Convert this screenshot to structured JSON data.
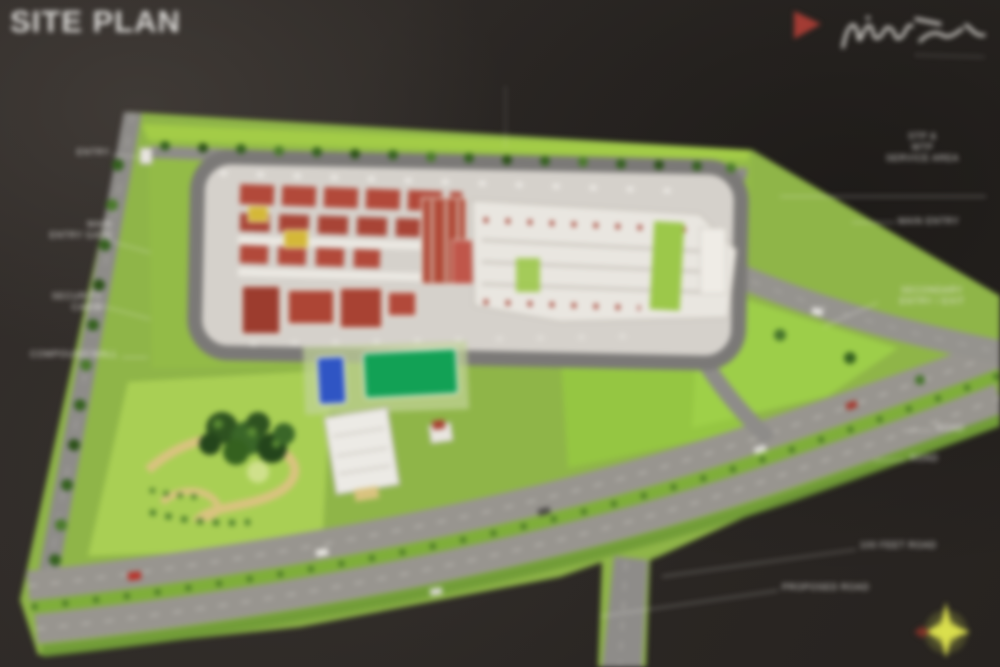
{
  "page": {
    "title": "SITE PLAN"
  },
  "brand": {
    "accent_color": "#a33c34",
    "compass_color": "#dde24e"
  },
  "labels": {
    "left": [
      {
        "lines": [
          "ENTRY"
        ]
      },
      {
        "lines": [
          "MAIN",
          "ENTRY GATE"
        ]
      },
      {
        "lines": [
          "SECURITY",
          "CABIN"
        ]
      },
      {
        "lines": [
          "COMPOUND WALL"
        ]
      }
    ],
    "right": [
      {
        "lines": [
          "STP &",
          "WTP",
          "SERVICE AREA"
        ]
      },
      {
        "lines": [
          "MAIN ENTRY"
        ]
      },
      {
        "lines": [
          "SECONDARY",
          "ENTRY / EXIT"
        ]
      },
      {
        "lines": [
          "ROAD"
        ]
      },
      {
        "lines": [
          "ROAD"
        ]
      },
      {
        "lines": [
          "100 FEET ROAD"
        ]
      },
      {
        "lines": [
          "PROPOSED ROAD"
        ]
      }
    ]
  },
  "map_features": [
    "entry-road",
    "perimeter-ring-road",
    "red-roof-apartment-blocks",
    "white-apartment-blocks",
    "swimming-pool",
    "sports-court",
    "clubhouse",
    "central-park",
    "tree-cluster",
    "roundabout",
    "arterial-road",
    "green-median",
    "service-road"
  ],
  "colors": {
    "background": "#2d2926",
    "lawn": "#8fb548",
    "lawn_bright": "#9ed049",
    "road": "#98958f",
    "ring_road": "#7b7977",
    "roof_red": "#b2493a",
    "building_white": "#e9e6e0",
    "pool_blue": "#2f55c4",
    "court_green": "#12a155",
    "path_tan": "#d9c37f",
    "tree_dark": "#2e5220",
    "label_text": "#eceae6"
  }
}
